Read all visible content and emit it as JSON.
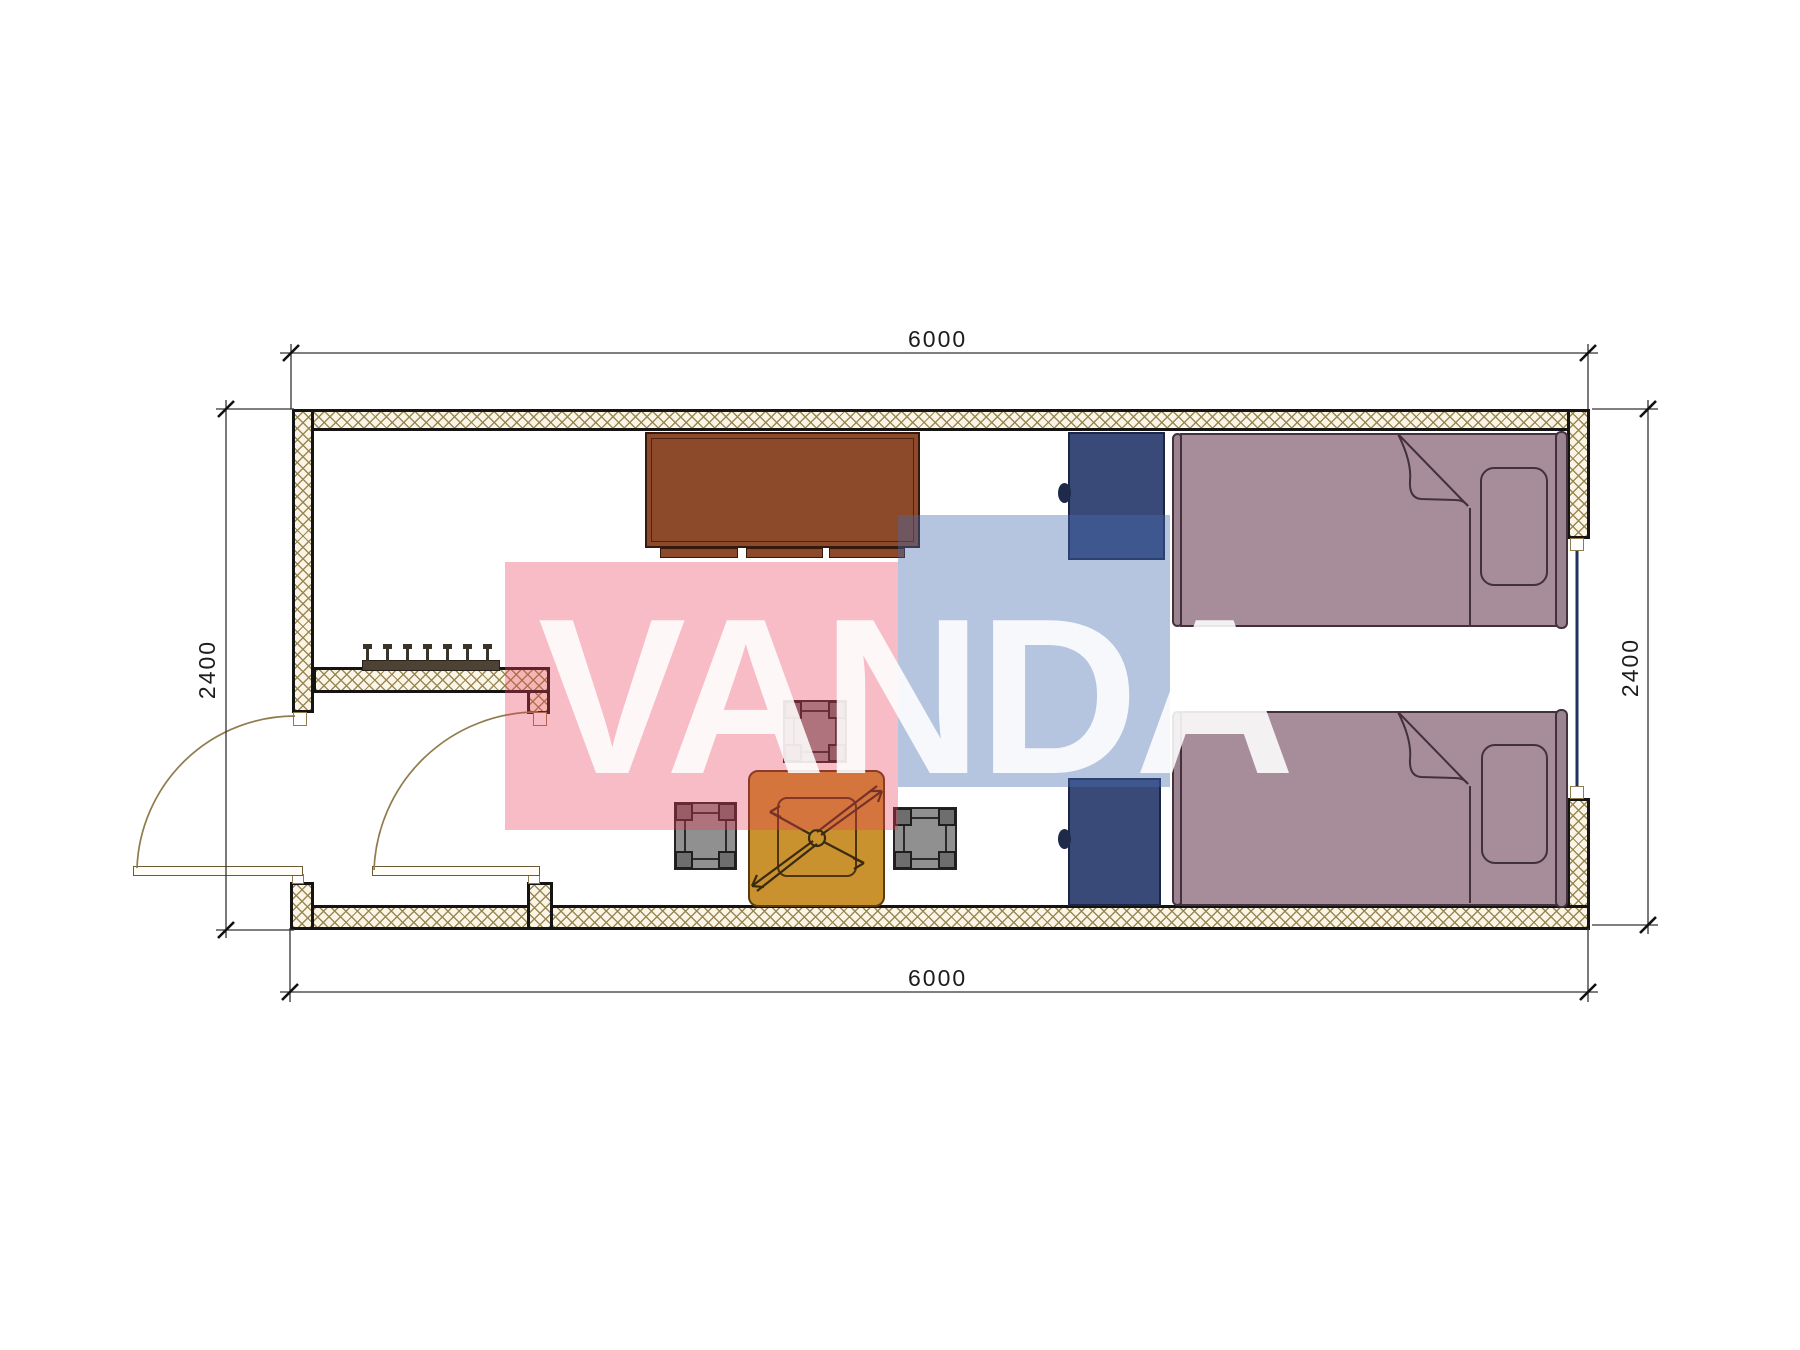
{
  "drawing": {
    "type": "floor-plan",
    "module_width_mm": "6000",
    "module_depth_mm": "2400"
  },
  "dimensions": {
    "top": "6000",
    "bottom": "6000",
    "left": "2400",
    "right": "2400"
  },
  "watermark": {
    "text": "VANDA",
    "pink_color": "#e94058",
    "blue_color": "#466caf"
  },
  "colors": {
    "wall_hatch": "#96824c",
    "wall_fill": "#faf5e6",
    "cabinet": "#8c4a2a",
    "nightstand": "#3a4a78",
    "bed": "#a78d99",
    "table": "#c9922e",
    "stool": "#909090",
    "door_arc": "#8f7c4c",
    "window_glass": "#203060",
    "dimension_lines": "#333333"
  },
  "furniture": {
    "items": [
      "wardrobe-cabinet",
      "coat-rack",
      "nightstand-1",
      "bed-1",
      "nightstand-2",
      "bed-2",
      "tea-table",
      "stool-top",
      "stool-left",
      "stool-right"
    ],
    "openings": [
      "entry-door",
      "inner-door",
      "window-right-wall"
    ]
  }
}
